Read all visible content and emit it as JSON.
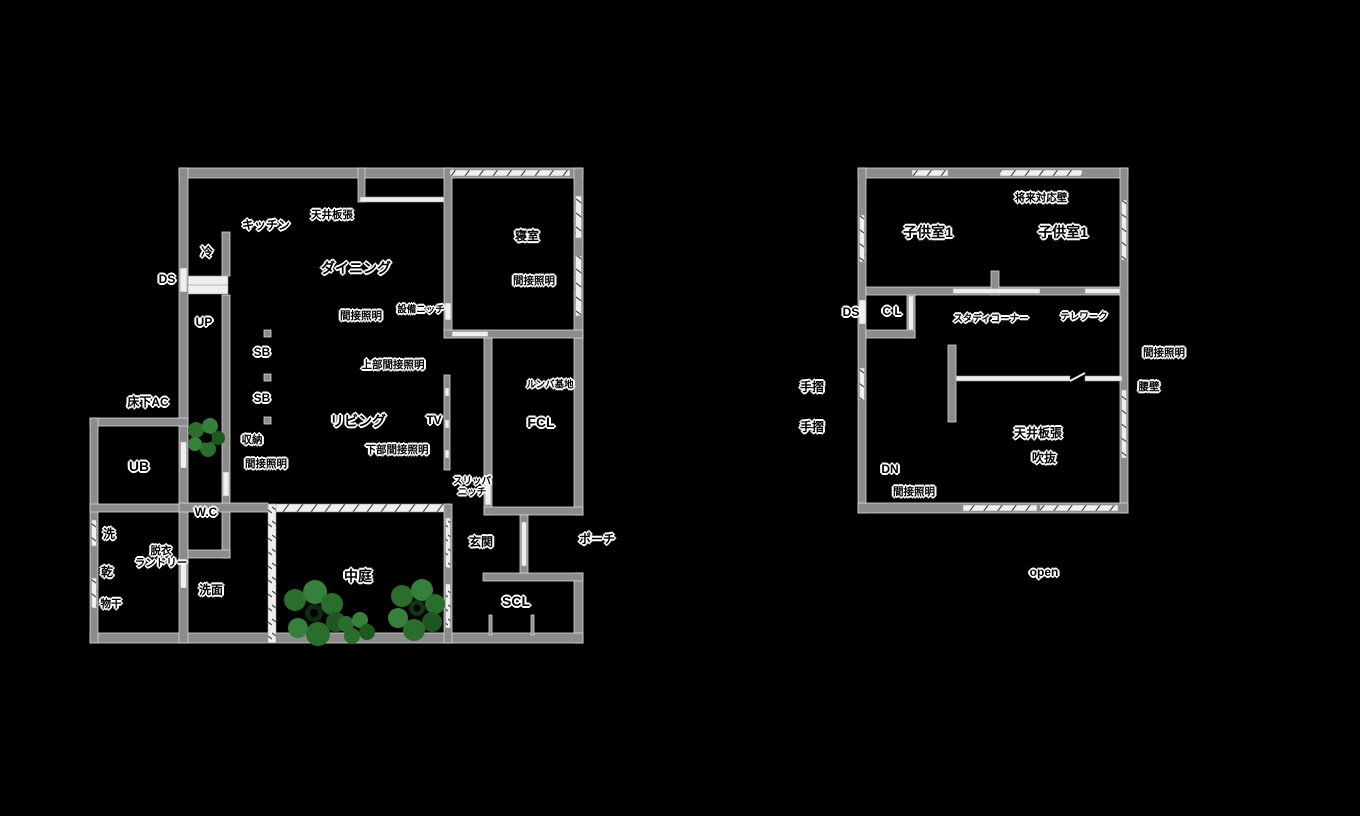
{
  "title": "floor-plan",
  "colors": {
    "background": "#000000",
    "wall": "#8c8c8c",
    "wall_edge": "#d8d8d8",
    "window": "#efefef",
    "tree_green_dark": "#1e571f",
    "tree_green_mid": "#2a6e2b",
    "tree_green_light": "#35803a",
    "label_text": "#000000",
    "label_halo": "#ffffff"
  },
  "floor1": {
    "labels": [
      {
        "name": "ds",
        "text": "DS",
        "x": 167,
        "y": 280,
        "s": "m"
      },
      {
        "name": "fridge",
        "text": "冷",
        "x": 207,
        "y": 253,
        "s": "m"
      },
      {
        "name": "kitchen",
        "text": "キッチン",
        "x": 266,
        "y": 226,
        "s": "m"
      },
      {
        "name": "ceiling-board",
        "text": "天井板張",
        "x": 332,
        "y": 215,
        "s": "s"
      },
      {
        "name": "dining",
        "text": "ダイニング",
        "x": 356,
        "y": 268,
        "s": "l"
      },
      {
        "name": "indirect-dining",
        "text": "間接照明",
        "x": 361,
        "y": 316,
        "s": "s"
      },
      {
        "name": "equipment-niche",
        "text": "設備ニッチ",
        "x": 421,
        "y": 311,
        "s": "xs"
      },
      {
        "name": "up",
        "text": "UP",
        "x": 204,
        "y": 323,
        "s": "m"
      },
      {
        "name": "sb-1",
        "text": "SB",
        "x": 262,
        "y": 353,
        "s": "m"
      },
      {
        "name": "sb-2",
        "text": "SB",
        "x": 262,
        "y": 399,
        "s": "m"
      },
      {
        "name": "upper-indirect",
        "text": "上部間接照明",
        "x": 393,
        "y": 365,
        "s": "s"
      },
      {
        "name": "underfloor-ac",
        "text": "床下AC",
        "x": 148,
        "y": 403,
        "s": "m"
      },
      {
        "name": "living",
        "text": "リビング",
        "x": 358,
        "y": 421,
        "s": "l"
      },
      {
        "name": "tv",
        "text": "TV",
        "x": 434,
        "y": 421,
        "s": "m"
      },
      {
        "name": "lower-indirect",
        "text": "下部間接照明",
        "x": 397,
        "y": 450,
        "s": "s"
      },
      {
        "name": "storage",
        "text": "収納",
        "x": 252,
        "y": 440,
        "s": "s"
      },
      {
        "name": "indirect-storage",
        "text": "間接照明",
        "x": 266,
        "y": 464,
        "s": "s"
      },
      {
        "name": "ub",
        "text": "UB",
        "x": 139,
        "y": 466,
        "s": "l"
      },
      {
        "name": "wc",
        "text": "W.C",
        "x": 206,
        "y": 513,
        "s": "m"
      },
      {
        "name": "washer",
        "text": "洗",
        "x": 109,
        "y": 535,
        "s": "m"
      },
      {
        "name": "dryer",
        "text": "乾",
        "x": 107,
        "y": 573,
        "s": "m"
      },
      {
        "name": "drying-pole",
        "text": "物干",
        "x": 111,
        "y": 604,
        "s": "s"
      },
      {
        "name": "laundry",
        "text": "脱衣\nランドリー",
        "x": 161,
        "y": 557,
        "s": "s"
      },
      {
        "name": "washroom",
        "text": "洗面",
        "x": 211,
        "y": 591,
        "s": "m"
      },
      {
        "name": "courtyard",
        "text": "中庭",
        "x": 358,
        "y": 576,
        "s": "l"
      },
      {
        "name": "genkan",
        "text": "玄関",
        "x": 481,
        "y": 543,
        "s": "m"
      },
      {
        "name": "porch",
        "text": "ポーチ",
        "x": 597,
        "y": 540,
        "s": "m"
      },
      {
        "name": "scl",
        "text": "SCL",
        "x": 516,
        "y": 601,
        "s": "l"
      },
      {
        "name": "bedroom",
        "text": "寝室",
        "x": 527,
        "y": 237,
        "s": "m"
      },
      {
        "name": "indirect-bedroom",
        "text": "間接照明",
        "x": 534,
        "y": 281,
        "s": "s"
      },
      {
        "name": "roomba-base",
        "text": "ルンバ基地",
        "x": 550,
        "y": 386,
        "s": "xs"
      },
      {
        "name": "fcl",
        "text": "FCL",
        "x": 541,
        "y": 422,
        "s": "l"
      },
      {
        "name": "slipper-niche",
        "text": "スリッパ\nニッチ",
        "x": 472,
        "y": 488,
        "s": "xs"
      }
    ]
  },
  "floor2": {
    "labels": [
      {
        "name": "future-wall",
        "text": "将来対応壁",
        "x": 1041,
        "y": 198,
        "s": "s"
      },
      {
        "name": "kids-room-1",
        "text": "子供室1",
        "x": 928,
        "y": 232,
        "s": "l"
      },
      {
        "name": "kids-room-2",
        "text": "子供室1",
        "x": 1063,
        "y": 232,
        "s": "l"
      },
      {
        "name": "ds",
        "text": "DS",
        "x": 851,
        "y": 313,
        "s": "m"
      },
      {
        "name": "cl",
        "text": "C L",
        "x": 892,
        "y": 312,
        "s": "m"
      },
      {
        "name": "study-corner",
        "text": "スタディコーナー",
        "x": 991,
        "y": 320,
        "s": "xs"
      },
      {
        "name": "telework",
        "text": "テレワーク",
        "x": 1084,
        "y": 318,
        "s": "xs"
      },
      {
        "name": "indirect-right",
        "text": "間接照明",
        "x": 1164,
        "y": 353,
        "s": "s"
      },
      {
        "name": "half-wall",
        "text": "腰壁",
        "x": 1149,
        "y": 387,
        "s": "s"
      },
      {
        "name": "handrail-1",
        "text": "手摺",
        "x": 812,
        "y": 388,
        "s": "m"
      },
      {
        "name": "handrail-2",
        "text": "手摺",
        "x": 812,
        "y": 428,
        "s": "m"
      },
      {
        "name": "dn",
        "text": "DN",
        "x": 890,
        "y": 470,
        "s": "m"
      },
      {
        "name": "indirect-stairs",
        "text": "間接照明",
        "x": 914,
        "y": 492,
        "s": "s"
      },
      {
        "name": "ceiling-board",
        "text": "天井板張",
        "x": 1038,
        "y": 434,
        "s": "m"
      },
      {
        "name": "void",
        "text": "吹抜",
        "x": 1044,
        "y": 459,
        "s": "m"
      },
      {
        "name": "open",
        "text": "open",
        "x": 1044,
        "y": 573,
        "s": "m"
      }
    ]
  }
}
